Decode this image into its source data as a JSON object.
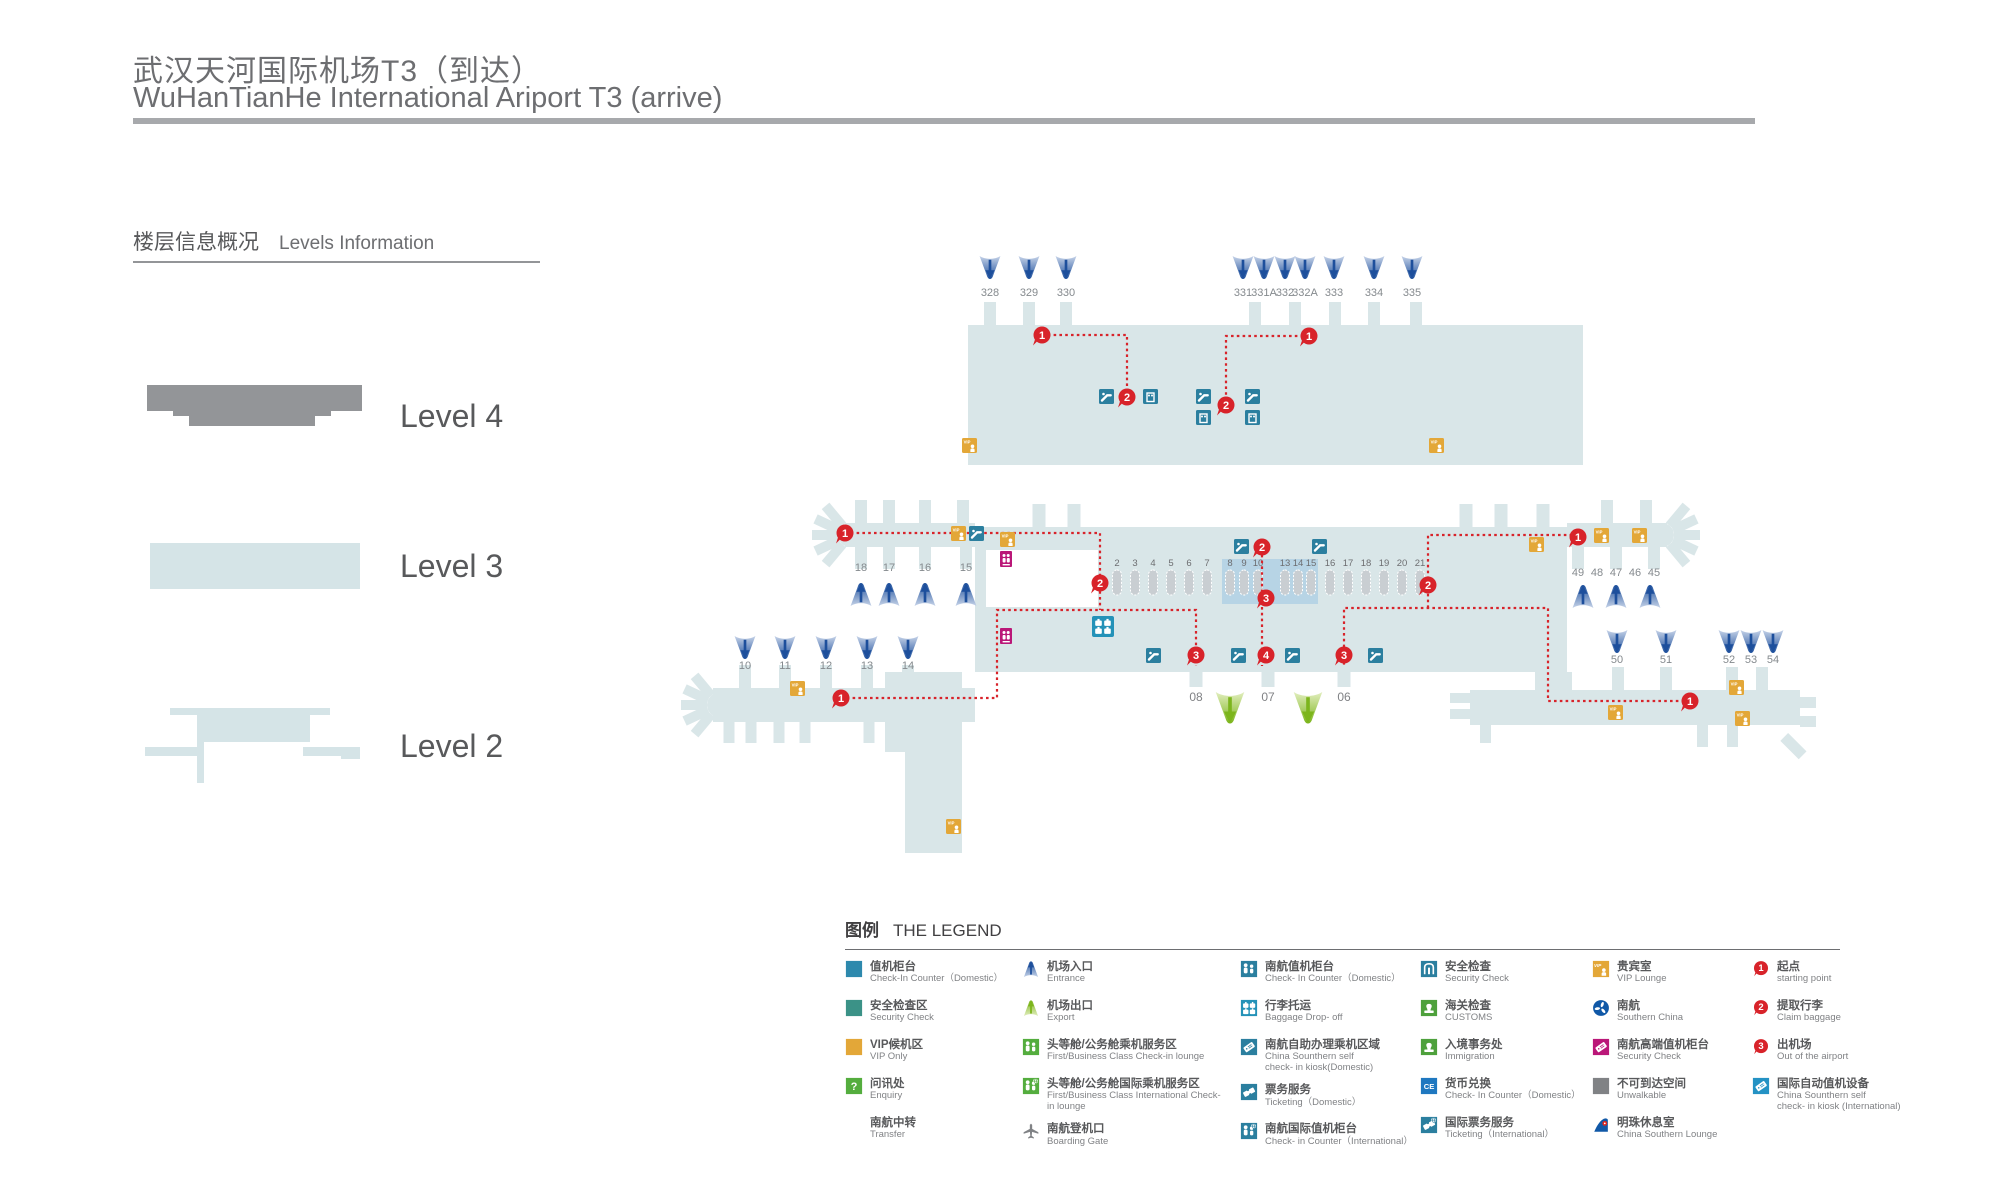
{
  "header": {
    "title_cn": "武汉天河国际机场T3（到达）",
    "title_en": "WuHanTianHe International  Ariport T3 (arrive)"
  },
  "levels": {
    "section_title_cn": "楼层信息概况",
    "section_title_en": "Levels Information",
    "items": [
      {
        "label": "Level 4"
      },
      {
        "label": "Level 3"
      },
      {
        "label": "Level 2"
      }
    ]
  },
  "colors": {
    "body": "#d9e6e8",
    "highlight": "#b7d4e5",
    "counter": "#c9ced2",
    "red": "#d8232a",
    "teal": "#2b7f9f",
    "baggage_blue": "#2492b8",
    "gold": "#e3a738",
    "magenta": "#ba1778",
    "blue_dark": "#1d4f9c",
    "blue_light": "#c6d3e8",
    "green_dark": "#7cb51c",
    "green_light": "#e2eebf",
    "gray_level4": "#939598",
    "gray_unwalkable": "#808285",
    "cs_blue": "#1058a7"
  },
  "map": {
    "top_gates": {
      "labels": [
        "328",
        "329",
        "330",
        "331",
        "331A",
        "332",
        "332A",
        "333",
        "334",
        "335"
      ],
      "x": [
        990,
        1029,
        1066,
        1243,
        1264,
        1285,
        1305,
        1334,
        1374,
        1412
      ]
    },
    "gates_upper_left": {
      "labels": [
        "18",
        "17",
        "16",
        "15"
      ],
      "x": [
        861,
        889,
        925,
        966
      ]
    },
    "gates_lower_left": {
      "labels": [
        "10",
        "11",
        "12",
        "13",
        "14"
      ],
      "x": [
        745,
        785,
        826,
        867,
        908
      ]
    },
    "gates_upper_right": {
      "labels": [
        "49",
        "48",
        "47",
        "46",
        "45"
      ],
      "x": [
        1578,
        1597,
        1616,
        1635,
        1654
      ],
      "arrows_x": [
        1583,
        1616,
        1650
      ]
    },
    "gates_lower_right": {
      "labels": [
        "50",
        "51",
        "52",
        "53",
        "54"
      ],
      "x": [
        1617,
        1666,
        1729,
        1751,
        1773
      ]
    },
    "exits": {
      "labels": [
        "08",
        "07",
        "06"
      ],
      "x": [
        1196,
        1268,
        1344
      ]
    },
    "counters": {
      "labels": [
        "2",
        "3",
        "4",
        "5",
        "6",
        "7",
        "8",
        "9",
        "10",
        "13",
        "14",
        "15",
        "16",
        "17",
        "18",
        "19",
        "20",
        "21"
      ],
      "x": [
        1117,
        1135,
        1153,
        1171,
        1189,
        1207,
        1230,
        1244,
        1258,
        1285,
        1298,
        1311,
        1330,
        1348,
        1366,
        1384,
        1402,
        1420
      ]
    },
    "markers": [
      {
        "n": "1",
        "x": 1042,
        "y": 335
      },
      {
        "n": "2",
        "x": 1127,
        "y": 397
      },
      {
        "n": "1",
        "x": 1309,
        "y": 336
      },
      {
        "n": "2",
        "x": 1226,
        "y": 405
      },
      {
        "n": "1",
        "x": 845,
        "y": 533
      },
      {
        "n": "2",
        "x": 1100,
        "y": 583
      },
      {
        "n": "2",
        "x": 1262,
        "y": 547
      },
      {
        "n": "3",
        "x": 1266,
        "y": 598
      },
      {
        "n": "3",
        "x": 1196,
        "y": 655
      },
      {
        "n": "4",
        "x": 1266,
        "y": 655
      },
      {
        "n": "3",
        "x": 1344,
        "y": 655
      },
      {
        "n": "2",
        "x": 1428,
        "y": 585
      },
      {
        "n": "1",
        "x": 1578,
        "y": 537
      },
      {
        "n": "1",
        "x": 841,
        "y": 698
      },
      {
        "n": "1",
        "x": 1690,
        "y": 701
      }
    ]
  },
  "legend": {
    "title_cn": "图例",
    "title_en": "THE LEGEND",
    "columns": [
      [
        {
          "icon": "sq_blue",
          "cn": "值机柜台",
          "en": "Check-In Counter（Domestic）"
        },
        {
          "icon": "sq_teal",
          "cn": "安全检查区",
          "en": "Security Check"
        },
        {
          "icon": "sq_orange",
          "cn": "VIP候机区",
          "en": "VIP Only"
        },
        {
          "icon": "enquiry",
          "cn": "问讯处",
          "en": "Enquiry"
        },
        {
          "icon": "none",
          "cn": "南航中转",
          "en": "Transfer"
        }
      ],
      [
        {
          "icon": "cone_blue",
          "cn": "机场入口",
          "en": "Entrance"
        },
        {
          "icon": "cone_green",
          "cn": "机场出口",
          "en": "Export"
        },
        {
          "icon": "people_green",
          "cn": "头等舱/公务舱乘机服务区",
          "en": "First/Business Class Check-in lounge"
        },
        {
          "icon": "people_globe_green",
          "cn": "头等舱/公务舱国际乘机服务区",
          "en": "First/Business Class International Check-in lounge"
        },
        {
          "icon": "plane",
          "cn": "南航登机口",
          "en": "Boarding Gate"
        }
      ],
      [
        {
          "icon": "people_teal",
          "cn": "南航值机柜台",
          "en": "Check- In Counter（Domestic）"
        },
        {
          "icon": "baggage",
          "cn": "行李托运",
          "en": "Baggage Drop- off"
        },
        {
          "icon": "kiosk_teal",
          "cn": "南航自助办理乘机区域",
          "en": "China Sounthern self\ncheck- in kiosk(Domestic)"
        },
        {
          "icon": "ticket_teal",
          "cn": "票务服务",
          "en": "Ticketing（Domestic）"
        },
        {
          "icon": "people_globe_teal",
          "cn": "南航国际值机柜台",
          "en": "Check- in Counter（International）"
        }
      ],
      [
        {
          "icon": "door",
          "cn": "安全检查",
          "en": "Security Check"
        },
        {
          "icon": "stamp",
          "cn": "海关检查",
          "en": "CUSTOMS"
        },
        {
          "icon": "stamp2",
          "cn": "入境事务处",
          "en": "Immigration"
        },
        {
          "icon": "ce",
          "cn": "货币兑换",
          "en": "Check- In Counter（Domestic）"
        },
        {
          "icon": "ticket_globe_teal",
          "cn": "国际票务服务",
          "en": "Ticketing（International）"
        }
      ],
      [
        {
          "icon": "vip",
          "cn": "贵宾室",
          "en": "VIP Lounge"
        },
        {
          "icon": "cs_circle",
          "cn": "南航",
          "en": "Southern China"
        },
        {
          "icon": "kiosk_magenta",
          "cn": "南航高端值机柜台",
          "en": "Security Check"
        },
        {
          "icon": "sq_gray",
          "cn": "不可到达空间",
          "en": "Unwalkable"
        },
        {
          "icon": "cs_fin",
          "cn": "明珠休息室",
          "en": "China Southern Lounge"
        }
      ],
      [
        {
          "icon": "red1",
          "cn": "起点",
          "en": "starting point"
        },
        {
          "icon": "red2",
          "cn": "提取行李",
          "en": "Claim baggage"
        },
        {
          "icon": "red3",
          "cn": "出机场",
          "en": "Out of the airport"
        },
        {
          "icon": "kiosk_blue",
          "cn": "国际自动值机设备",
          "en": "China Sounthern self\ncheck- in kiosk (International)"
        }
      ]
    ]
  }
}
